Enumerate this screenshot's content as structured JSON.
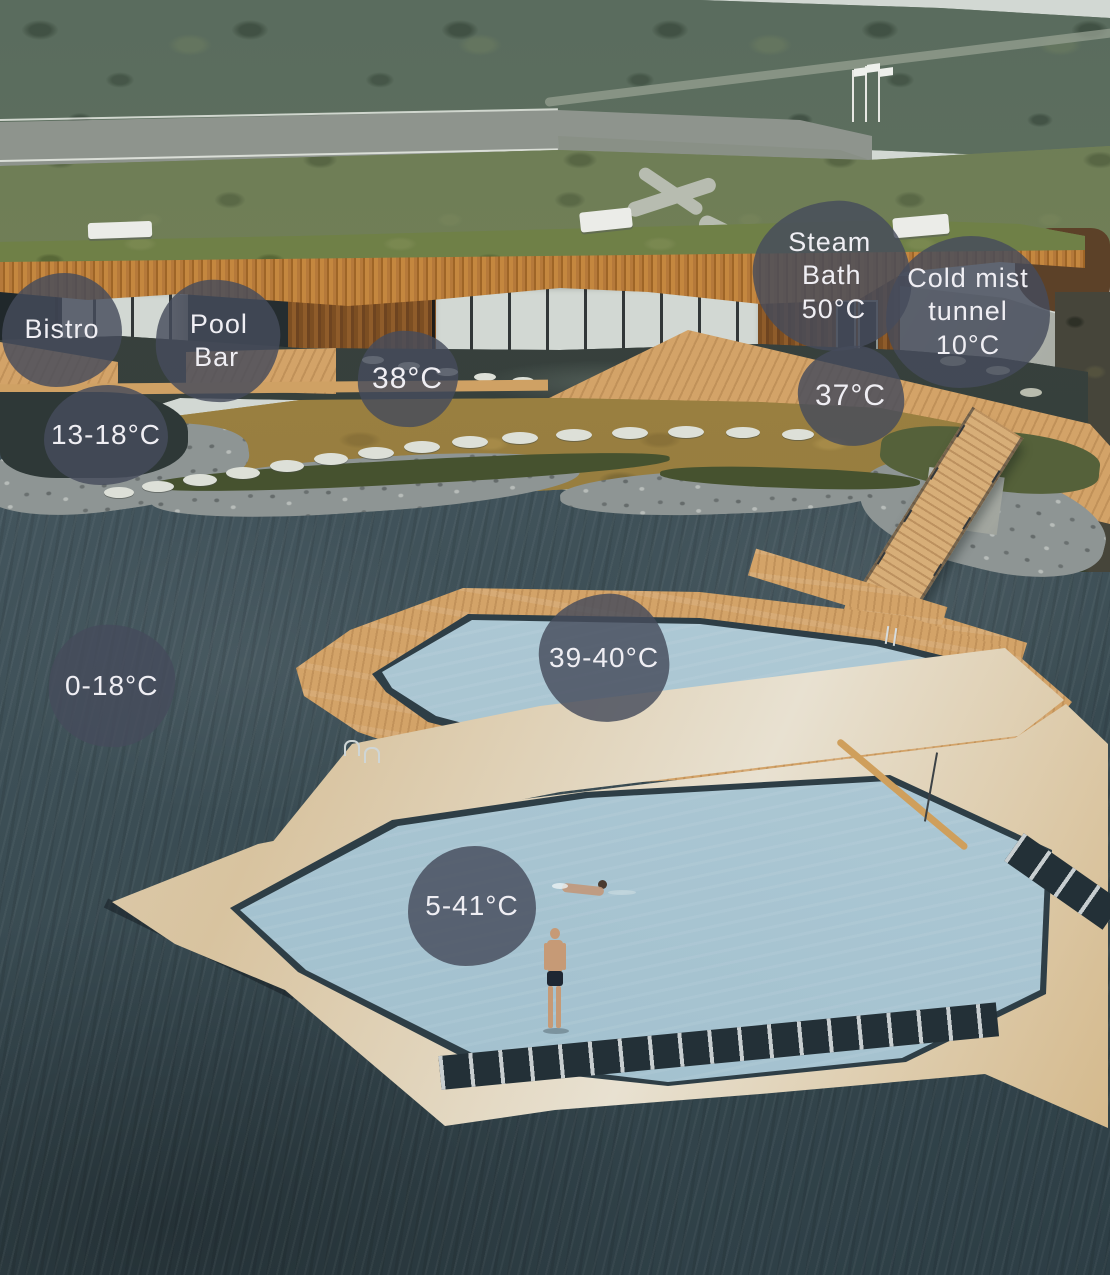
{
  "colors": {
    "badge_bg": "rgba(70,76,92,0.82)",
    "badge_text": "#efeef3",
    "pool_water": "#aac6d2",
    "lake_water": "#3d4f56",
    "deck_wood": "#d3a368",
    "roof_wood": "#b5793a",
    "grass": "#6d7e52"
  },
  "badges": [
    {
      "id": "bistro",
      "lines": [
        "Bistro"
      ],
      "x": 62,
      "y": 330,
      "w": 120,
      "h": 114,
      "font": 27
    },
    {
      "id": "pool-bar",
      "lines": [
        "Pool",
        "Bar"
      ],
      "x": 218,
      "y": 341,
      "w": 124,
      "h": 122,
      "font": 27
    },
    {
      "id": "steam-bath",
      "lines": [
        "Steam",
        "Bath",
        "50°C"
      ],
      "x": 832,
      "y": 276,
      "w": 158,
      "h": 150,
      "font": 27
    },
    {
      "id": "cold-mist-tunnel",
      "lines": [
        "Cold mist",
        "tunnel",
        "10°C"
      ],
      "x": 968,
      "y": 312,
      "w": 164,
      "h": 152,
      "font": 27
    },
    {
      "id": "temp-38",
      "lines": [
        "38°C"
      ],
      "x": 408,
      "y": 379,
      "w": 100,
      "h": 96,
      "font": 30
    },
    {
      "id": "temp-37",
      "lines": [
        "37°C"
      ],
      "x": 851,
      "y": 396,
      "w": 106,
      "h": 100,
      "font": 30
    },
    {
      "id": "temp-13-18",
      "lines": [
        "13-18°C"
      ],
      "x": 106,
      "y": 435,
      "w": 124,
      "h": 100,
      "font": 28
    },
    {
      "id": "temp-0-18",
      "lines": [
        "0-18°C"
      ],
      "x": 112,
      "y": 686,
      "w": 126,
      "h": 122,
      "font": 28
    },
    {
      "id": "temp-39-40",
      "lines": [
        "39-40°C"
      ],
      "x": 604,
      "y": 658,
      "w": 130,
      "h": 128,
      "font": 28
    },
    {
      "id": "temp-5-41",
      "lines": [
        "5-41°C"
      ],
      "x": 472,
      "y": 906,
      "w": 128,
      "h": 120,
      "font": 28
    }
  ]
}
